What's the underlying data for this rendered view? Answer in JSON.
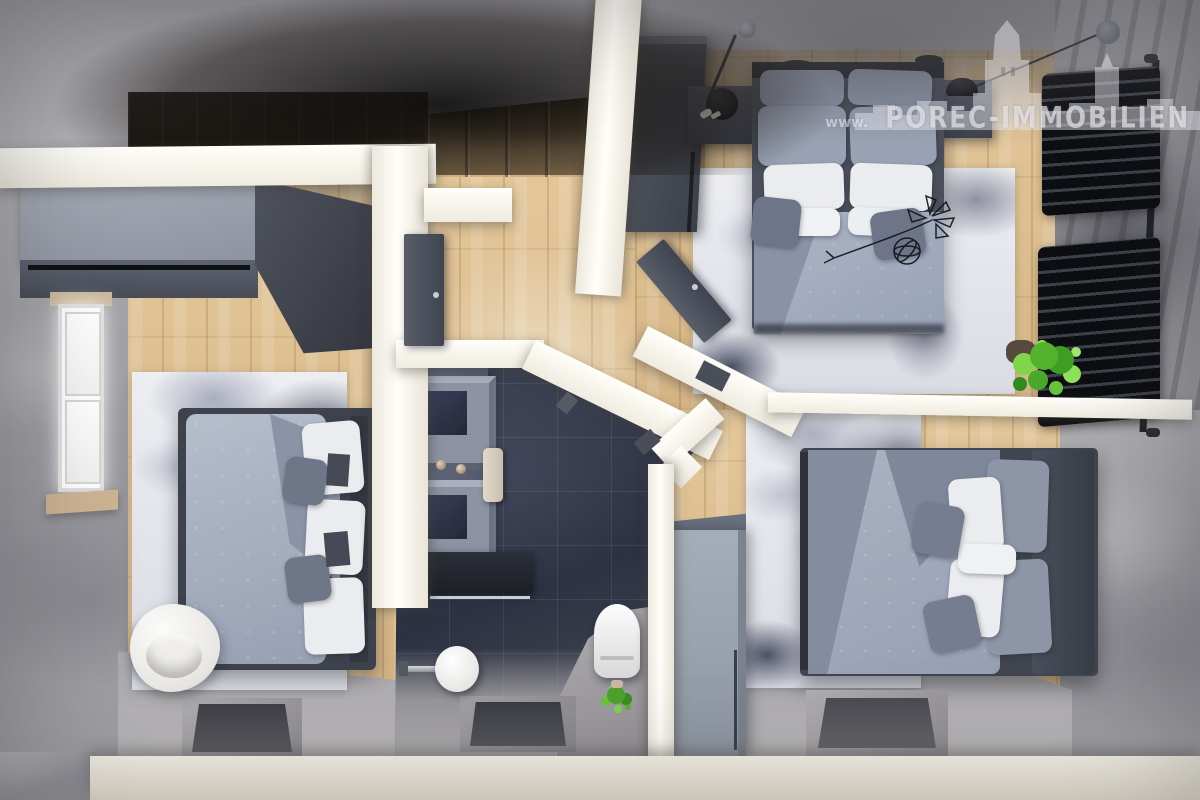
{
  "watermark": {
    "prefix": "www.",
    "brand": "POREC-IMMOBILIEN",
    "suffix": ".hr"
  },
  "palette": {
    "concrete": "#a9a8ad",
    "concrete-dark": "#78777d",
    "wood": "#debf92",
    "wood-dark": "#c6a26e",
    "wall": "#f8f5ee",
    "cream": "#f2ecdf",
    "tile": "#343a4b",
    "furn-gray": "#8d95a8",
    "furn-light": "#abb4c5",
    "pillow-white": "#ebecef",
    "dark": "#1b1d22",
    "door": "#4b5059",
    "plant": "#63c23c",
    "wardrobe-top": "#9ba2ae",
    "wardrobe-front": "#52565f"
  }
}
